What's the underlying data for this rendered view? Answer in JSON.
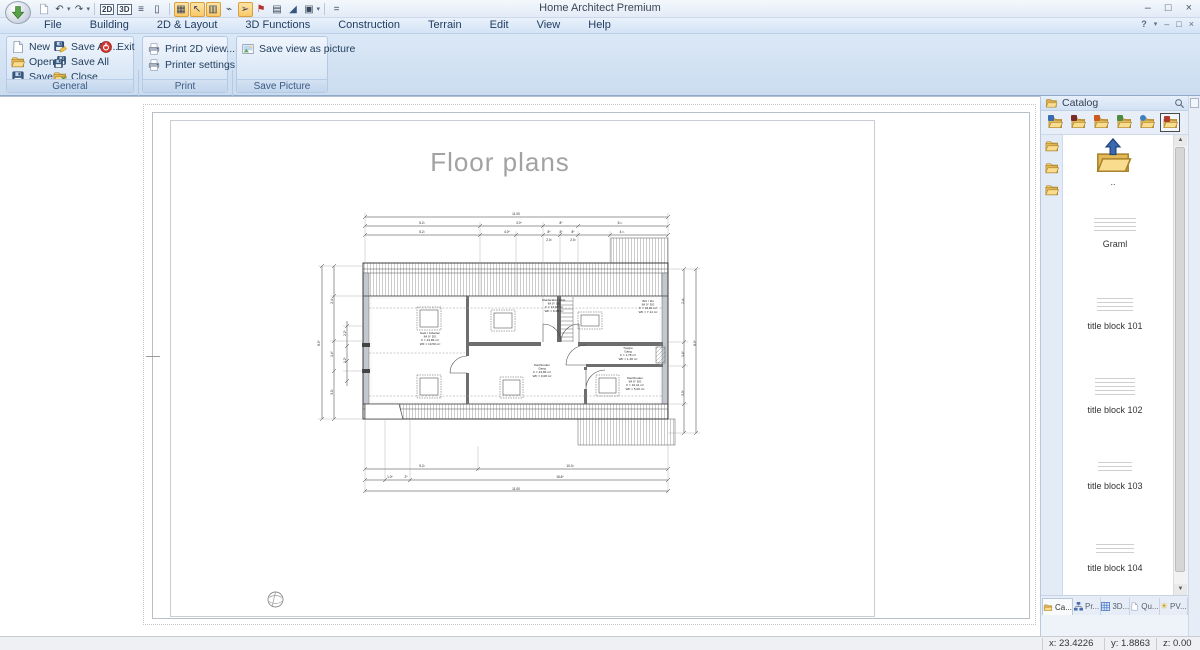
{
  "window": {
    "title": "Home Architect Premium",
    "controls": {
      "min": "–",
      "max": "□",
      "close": "×"
    },
    "help_glyph": "?"
  },
  "qat": {
    "view2d_label": "2D",
    "view3d_label": "3D",
    "more_label": "=",
    "icon_names": [
      "app-menu",
      "new-document",
      "undo",
      "redo",
      "view-2d",
      "view-3d",
      "horizontal-split",
      "column-split",
      "grid-snap",
      "select-sparkle",
      "multi-column",
      "measure-path",
      "pointer",
      "color-materials",
      "layout-grid",
      "roof-wedge",
      "copy",
      "customize-qat"
    ]
  },
  "menu": {
    "items": [
      "File",
      "Building",
      "2D & Layout",
      "3D Functions",
      "Construction",
      "Terrain",
      "Edit",
      "View",
      "Help"
    ]
  },
  "ribbon": {
    "groups": [
      {
        "label": "General",
        "items": [
          {
            "label": "New",
            "icon": "new-page"
          },
          {
            "label": "Open...",
            "icon": "open-folder"
          },
          {
            "label": "Save",
            "icon": "save-disk"
          },
          {
            "label": "Save As...",
            "icon": "save-as"
          },
          {
            "label": "Save All",
            "icon": "save-all"
          },
          {
            "label": "Close",
            "icon": "close-folder"
          },
          {
            "label": "Exit",
            "icon": "exit-power"
          }
        ]
      },
      {
        "label": "Print",
        "items": [
          {
            "label": "Print 2D view....",
            "icon": "printer"
          },
          {
            "label": "Printer settings...",
            "icon": "printer-settings"
          }
        ]
      },
      {
        "label": "Save Picture",
        "items": [
          {
            "label": "Save view as picture",
            "icon": "save-picture"
          }
        ]
      }
    ]
  },
  "canvas": {
    "page_title": "Floor plans"
  },
  "floorplan": {
    "rooms": [
      {
        "x": 430,
        "y": 333,
        "lines": [
          "Gast / Arbeiten",
          "IM 0° DG",
          "F = 24,86 m²",
          "WF = 19,50 m²"
        ]
      },
      {
        "x": 554,
        "y": 300,
        "lines": [
          "Kleiderabst. Abst.",
          "IM 0° DG",
          "F = 13,06 m²",
          "WF = 8,26 m²"
        ]
      },
      {
        "x": 648,
        "y": 301,
        "lines": [
          "WC / Du",
          "IM 0° DG",
          "F = 13,01 m²",
          "WF = 7,14 m²"
        ]
      },
      {
        "x": 628,
        "y": 348,
        "lines": [
          "Treppe",
          "Gang",
          "F = 1,78 m²",
          "WF = 1,38 m²"
        ]
      },
      {
        "x": 542,
        "y": 365,
        "lines": [
          "Dachboden",
          "Gang",
          "F = 24,86 m²",
          "WF = 9,08 m²"
        ]
      },
      {
        "x": 635,
        "y": 378,
        "lines": [
          "Dachboden",
          "IM 0° DG",
          "F = 10,41 m²",
          "WF = 5,00 m²"
        ]
      }
    ],
    "dims": [
      {
        "x": 516,
        "y": 214,
        "t": "11.00"
      },
      {
        "x": 422,
        "y": 223,
        "t": "5.2¹"
      },
      {
        "x": 519,
        "y": 223,
        "t": "3.0⁴"
      },
      {
        "x": 561,
        "y": 223,
        "t": "8⁶"
      },
      {
        "x": 620,
        "y": 223,
        "t": "5.¹¹"
      },
      {
        "x": 422,
        "y": 232,
        "t": "5.2¹"
      },
      {
        "x": 507,
        "y": 232,
        "t": "4.0⁶"
      },
      {
        "x": 549,
        "y": 232,
        "t": "8⁶"
      },
      {
        "x": 561,
        "y": 232,
        "t": "3⁶"
      },
      {
        "x": 573,
        "y": 232,
        "t": "8⁶"
      },
      {
        "x": 622,
        "y": 232,
        "t": "4.¹¹"
      },
      {
        "x": 549,
        "y": 240,
        "t": "2.0¹"
      },
      {
        "x": 573,
        "y": 240,
        "t": "2.0¹"
      },
      {
        "x": 422,
        "y": 466,
        "t": "5.2¹"
      },
      {
        "x": 570,
        "y": 466,
        "t": "10.0²"
      },
      {
        "x": 390,
        "y": 477,
        "t": "1.0⁶"
      },
      {
        "x": 406,
        "y": 477,
        "t": "2⁵"
      },
      {
        "x": 560,
        "y": 477,
        "t": "15.6⁹"
      },
      {
        "x": 516,
        "y": 489,
        "t": "11.00"
      },
      {
        "x": 320,
        "y": 342,
        "t": "8.9⁵",
        "r": -90
      },
      {
        "x": 333,
        "y": 300,
        "t": "2.4¹",
        "r": -90
      },
      {
        "x": 333,
        "y": 353,
        "t": "1.4⁶",
        "r": -90
      },
      {
        "x": 333,
        "y": 391,
        "t": "3.0¹",
        "r": -90
      },
      {
        "x": 346,
        "y": 332,
        "t": "2.2⁵",
        "r": -90
      },
      {
        "x": 346,
        "y": 359,
        "t": "1.2⁵",
        "r": -90
      },
      {
        "x": 684,
        "y": 300,
        "t": "2.4¹",
        "r": -90
      },
      {
        "x": 684,
        "y": 353,
        "t": "1.4⁶",
        "r": -90
      },
      {
        "x": 684,
        "y": 392,
        "t": "3.3⁵",
        "r": -90
      },
      {
        "x": 696,
        "y": 342,
        "t": "8.9⁵",
        "r": -90
      }
    ]
  },
  "catalog": {
    "title": "Catalog",
    "up_label": "..",
    "items": [
      "Graml",
      "title block 101",
      "title block 102",
      "title block 103",
      "title block 104"
    ],
    "toolbar_icon_names": [
      "folder-arrow",
      "folder-book",
      "folder-objects",
      "folder-picture",
      "folder-globe",
      "folder-bricks"
    ],
    "tabs": [
      "Ca...",
      "Pr...",
      "3D...",
      "Qu...",
      "PV..."
    ]
  },
  "status": {
    "x": "x: 23.4226",
    "y": "y: 1.8863",
    "z": "z: 0.00"
  }
}
